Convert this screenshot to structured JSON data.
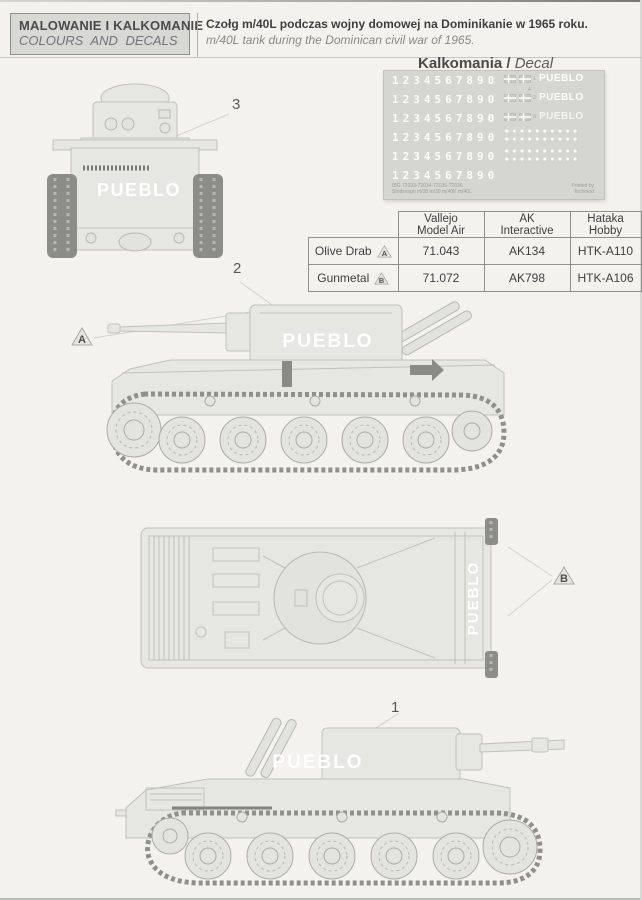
{
  "header": {
    "title_pl": "MALOWANIE I KALKOMANIE",
    "title_en": "COLOURS AND DECALS",
    "subject_pl": "Czołg m/40L podczas wojny domowej na Dominikanie w 1965 roku.",
    "subject_en": "m/40L tank during the Dominican civil war of 1965."
  },
  "decal_section": {
    "heading_pl": "Kalkomania",
    "heading_sep": "/",
    "heading_en": "Decal",
    "digits": "1234567890",
    "pueblo": "PUEBLO",
    "flag_labels": [
      "1",
      "4",
      "2",
      "3"
    ],
    "footer_left_line1": "IBG 72033-72034-72035-72036",
    "footer_left_line2": "Stridsvagn m/38 m/39 m/40K m/40L",
    "footer_right_line1": "Printed by",
    "footer_right_line2": "Techmod"
  },
  "paint_table": {
    "columns": [
      {
        "line1": "Vallejo",
        "line2": "Model Air"
      },
      {
        "line1": "AK",
        "line2": "Interactive"
      },
      {
        "line1": "Hataka",
        "line2": "Hobby"
      }
    ],
    "rows": [
      {
        "name": "Olive Drab",
        "marker": "A",
        "values": [
          "71.043",
          "AK134",
          "HTK-A110"
        ]
      },
      {
        "name": "Gunmetal",
        "marker": "B",
        "values": [
          "71.072",
          "AK798",
          "HTK-A106"
        ]
      }
    ]
  },
  "views": {
    "front": {
      "number": "3",
      "marking": "PUEBLO"
    },
    "side_left": {
      "number": "2",
      "marker": "A",
      "marking": "PUEBLO"
    },
    "top": {
      "marker": "B",
      "marking": "PUEBLO"
    },
    "side_right": {
      "number": "1",
      "marking": "PUEBLO"
    }
  },
  "colors": {
    "paper": "#f3f2ee",
    "header_box": "#d8d8d4",
    "decal_sheet": "#d6d6d1",
    "tank_fill": "#e6e7e2",
    "tank_line": "#c0c1bb",
    "track": "#90908a",
    "marking": "#ffffff",
    "text_dark": "#3f3f3d",
    "text_gray": "#898984"
  }
}
